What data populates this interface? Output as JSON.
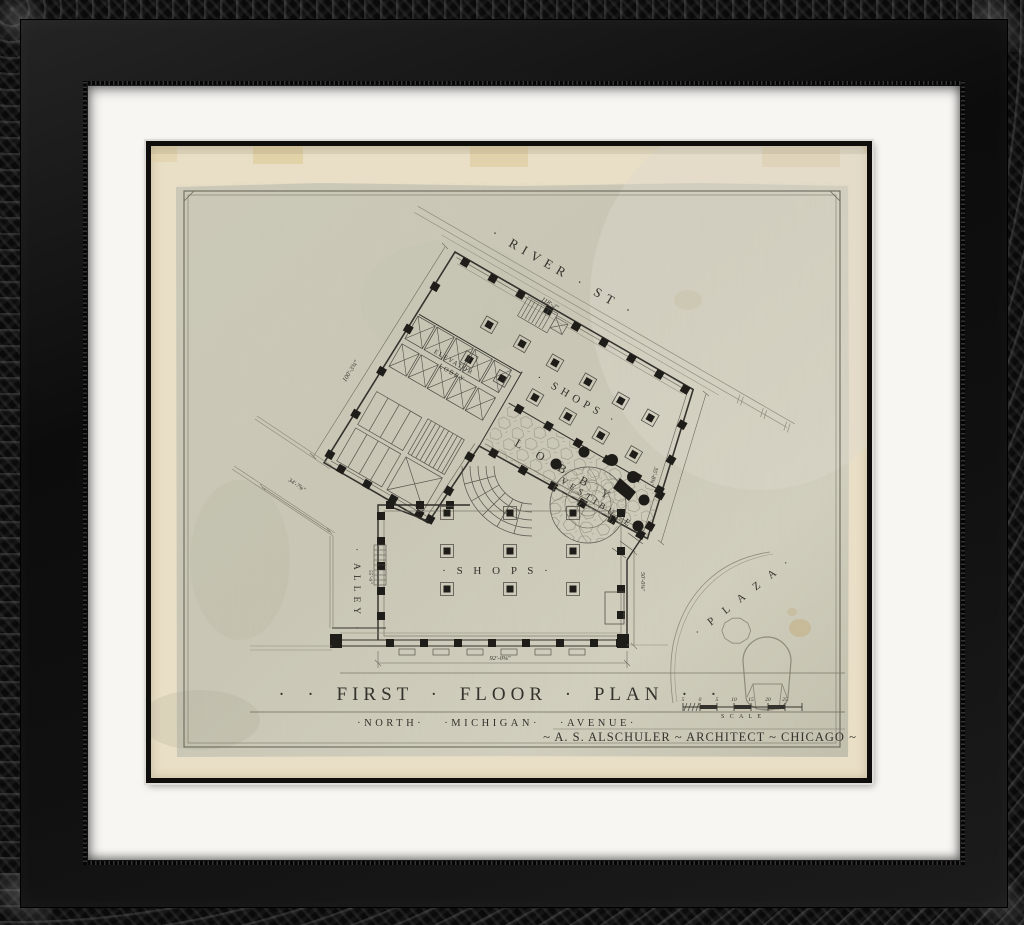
{
  "artwork": {
    "kind": "framed architectural drawing",
    "colors": {
      "frame": "#101010",
      "mat": "#f7f6f2",
      "paper_margin": "#e9dfc6",
      "sheet": "#cac7b6",
      "ink": "#34322c",
      "tape_stain": "#d9c391"
    },
    "plan": {
      "streets": {
        "river": "· RIVER · ST ·",
        "avenue": "·NORTH·  ·MICHIGAN·  ·AVENUE·",
        "alley": "· ALLEY ·",
        "plaza": "· P L A Z A ·"
      },
      "rooms": {
        "shops_upper": "· SHOPS ·",
        "shops_lower": "· S H O P S ·",
        "lobby": "L O B B Y",
        "elevator_line1": "ELEVATOR",
        "elevator_line2": "LOBBY",
        "vestibule": "VESTIBULE"
      },
      "title": "· ·  FIRST  ·  FLOOR  ·  PLAN  · ·",
      "credit": "~ A. S. ALSCHULER ~ ARCHITECT ~ CHICAGO ~",
      "scale": {
        "label": "S C A L E",
        "numbers": [
          "5",
          "0",
          "5",
          "10",
          "15",
          "20",
          "25"
        ]
      },
      "dims": {
        "river_frontage": "118'-2\"",
        "west_side": "100'-3¾\"",
        "alley_diagonal": "34'-7⅝\"",
        "east_chamfer": "35'-8⅝\"",
        "michigan_frontage": "92'-0⅝\"",
        "south_depth": "50'-0⅝\"",
        "alley_depth": "55'-0\""
      }
    }
  }
}
